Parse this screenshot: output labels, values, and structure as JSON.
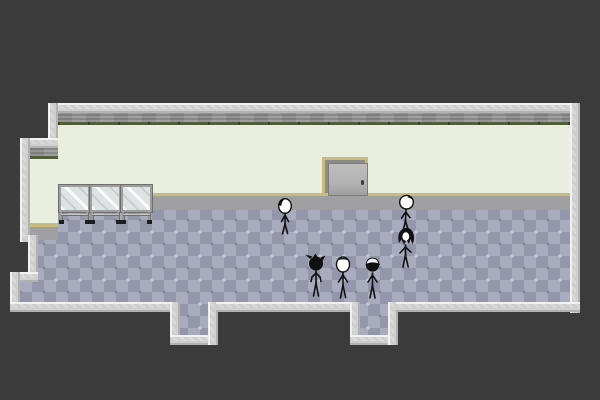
{
  "scene": {
    "description": "Pixel-art game room: six stick-figure characters stand on a purple diamond-tiled floor inside a pale green room with a gray door, three glass tables, and two tiled exit passages at the bottom edge.",
    "background_color": "#3b3b3b",
    "room": {
      "wall_color": "#eaeede",
      "wall_band_color": "#8f8f8f",
      "wall_trim_green": "#515e3d",
      "baseboard_color": "#c9ba7e",
      "border_color": "#d6d6d6",
      "floor_shadow_color": "#a0a0a2",
      "floor_base_color": "#9496ac",
      "floor_diamond_color": "#a9abbe",
      "floor_motif_light": "#c2c4d2",
      "floor_motif_dark": "#888aa0"
    },
    "objects": {
      "door": {
        "x": 322,
        "y": 157,
        "width": 46,
        "height": 39,
        "frame_color": "#c9ba7e",
        "panel_color": "#b3b3b3",
        "knob_color": "#3c3c3c"
      },
      "glass_tables": {
        "x": 59,
        "y": 185,
        "panel_width": 31,
        "count": 3,
        "glass_color": "#dde2e2",
        "frame_color": "#9e9e9e"
      },
      "exit_south_left": {
        "x": 180,
        "y": 312,
        "width": 28,
        "height": 23
      },
      "exit_south_right": {
        "x": 360,
        "y": 312,
        "width": 28,
        "height": 23
      }
    },
    "figures": [
      {
        "id": "figure-dark-hair-front",
        "x": 274,
        "y": 197,
        "desc": "stick figure facing front, white face, dark hair tuft upper-left"
      },
      {
        "id": "figure-bald-tilted",
        "x": 394,
        "y": 194,
        "desc": "stick figure, large white round head tilted, small dark tuft"
      },
      {
        "id": "figure-long-hair",
        "x": 393,
        "y": 226,
        "desc": "stick figure with long messy black hair, small white face"
      },
      {
        "id": "figure-spiky-back",
        "x": 303,
        "y": 253,
        "desc": "stick figure seen from behind, black spiky-haired head"
      },
      {
        "id": "figure-plain-front",
        "x": 331,
        "y": 255,
        "desc": "stick figure facing front, white oval head, thin hair line"
      },
      {
        "id": "figure-cap",
        "x": 360,
        "y": 255,
        "desc": "stick figure with white-topped cap over dark head"
      }
    ]
  }
}
